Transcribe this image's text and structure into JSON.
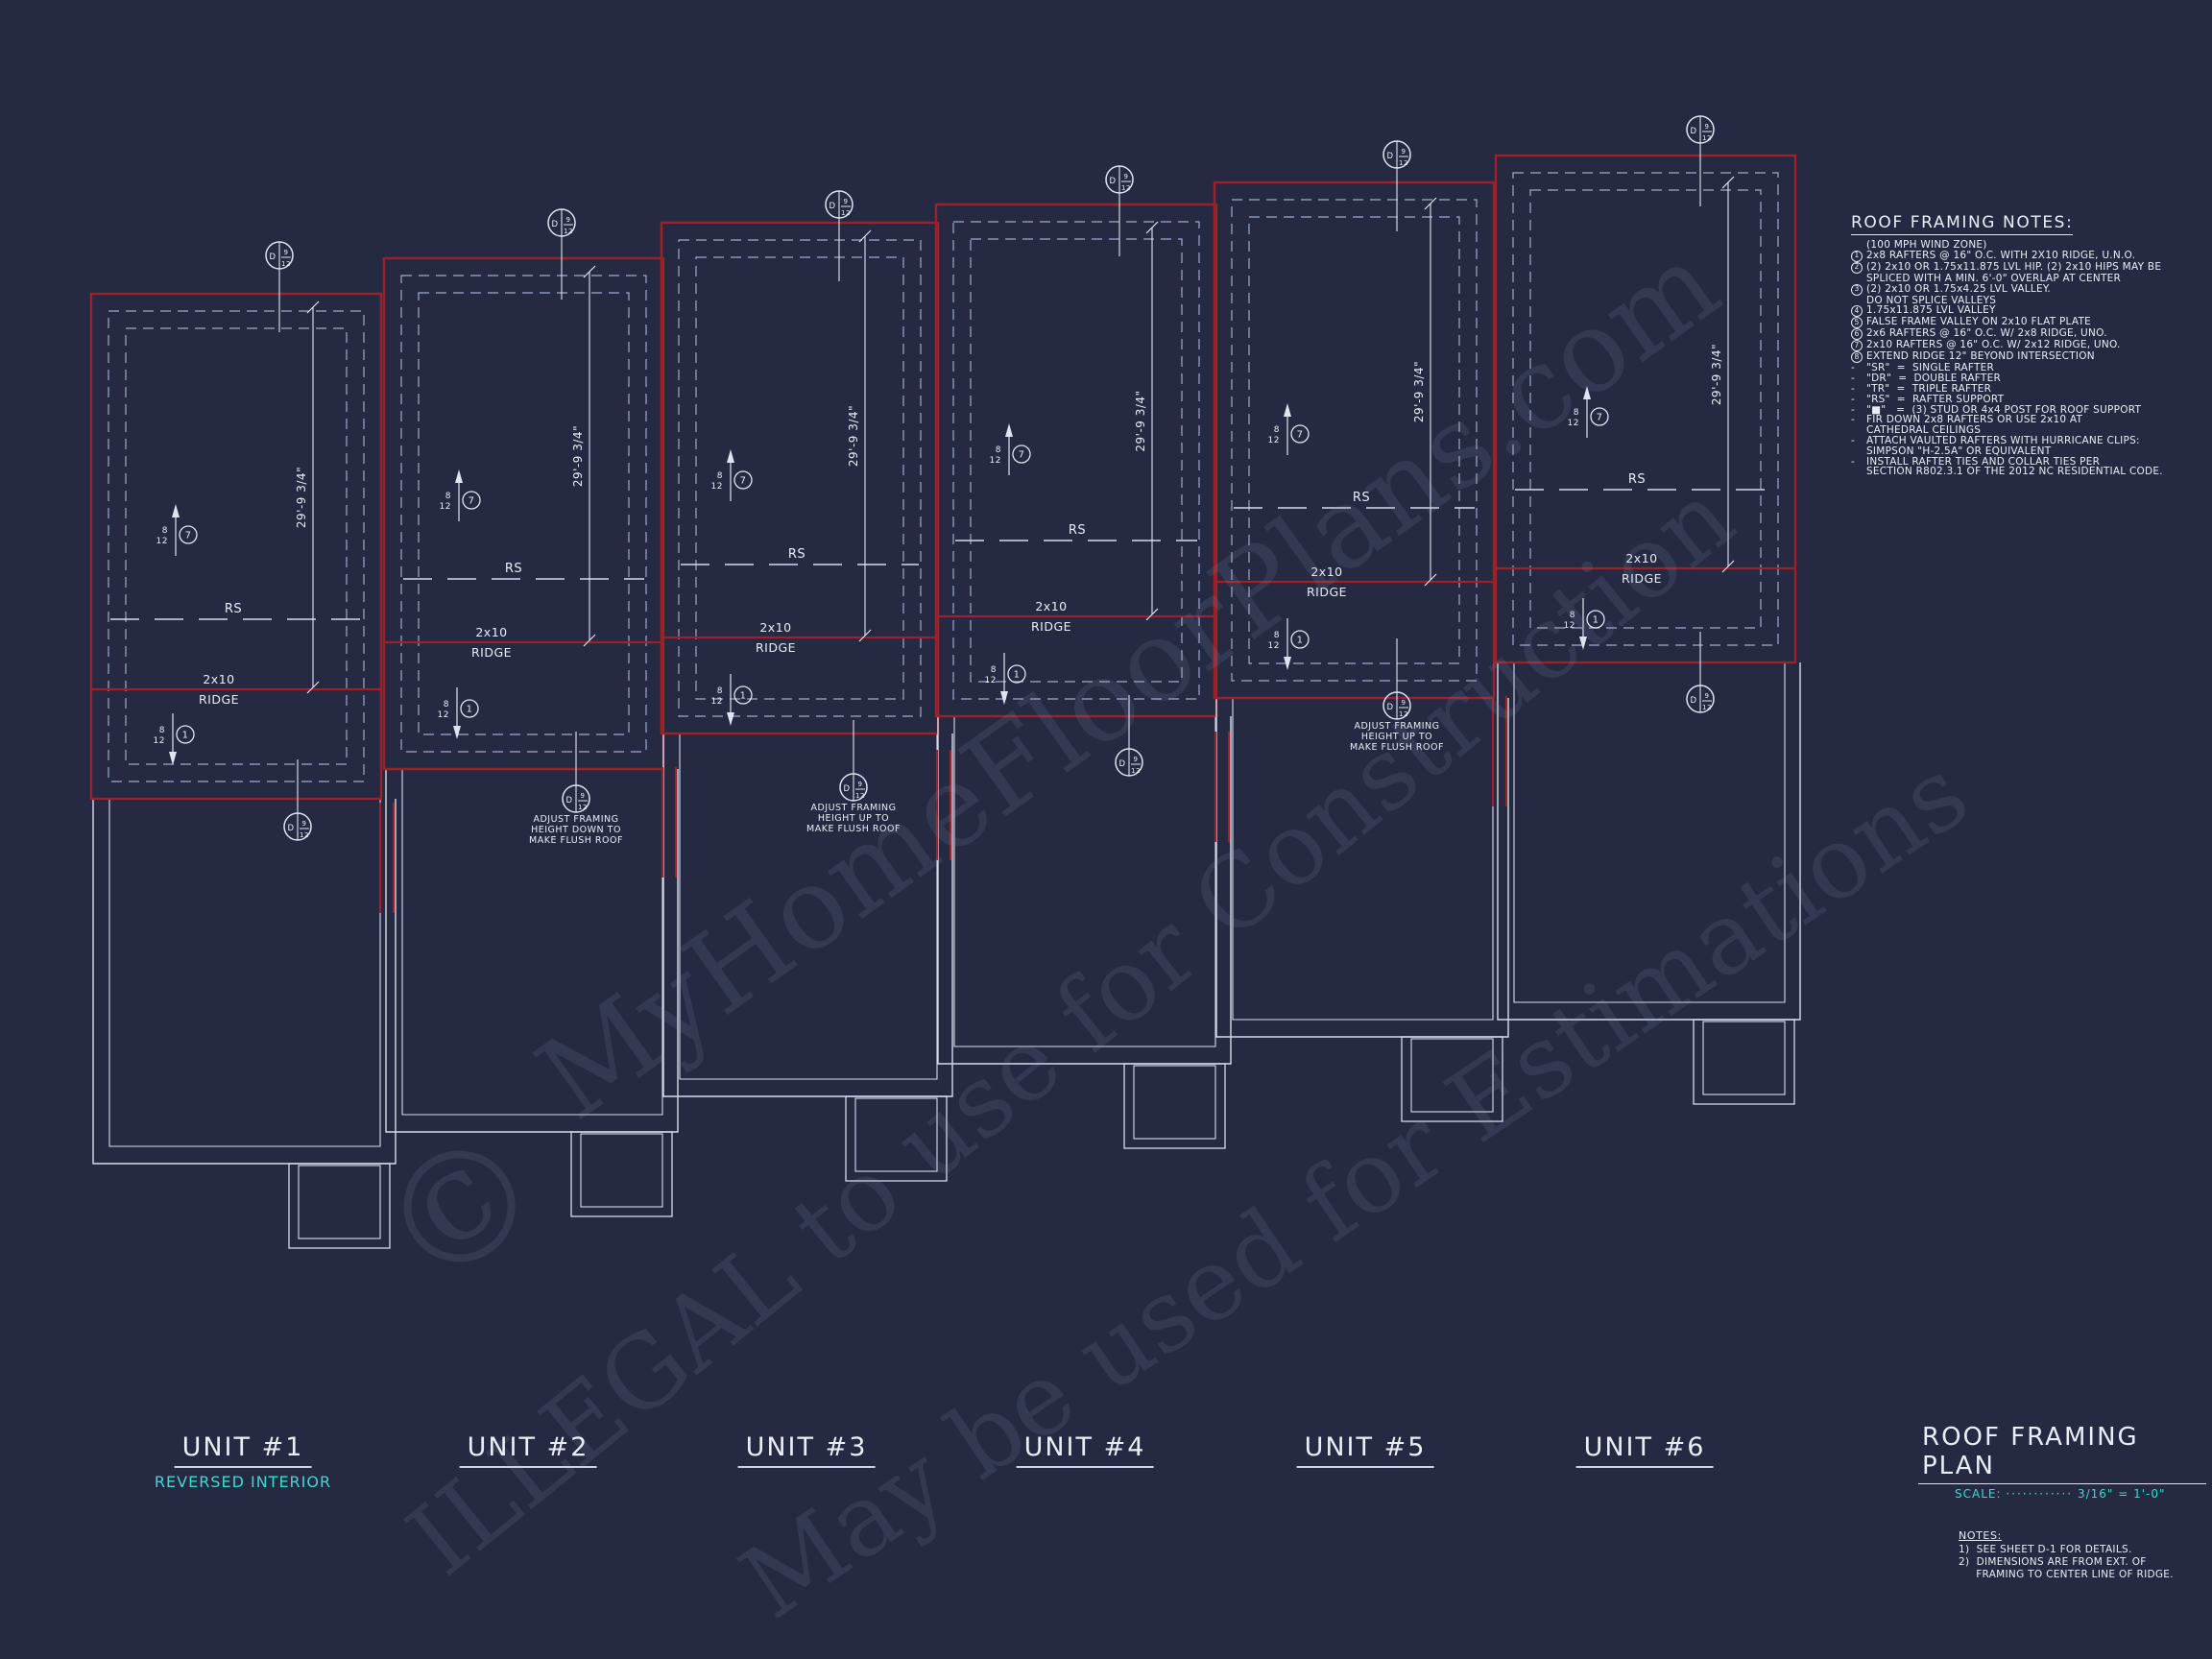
{
  "page": {
    "background": "#252a42"
  },
  "colors": {
    "line_red": "#9c2129",
    "line_white": "#dfe4f2",
    "line_gray": "#d6dbec",
    "dash_blue": "#9faacf",
    "text_white": "#e9edf8",
    "cyan": "#3fd9cf",
    "watermark": "rgba(155,165,200,0.13)"
  },
  "watermark": {
    "copyright": "©",
    "line1": "MyHomeFloorPlans.com",
    "line2": "ILLEGAL to use for Construction",
    "line3": "May be used for Estimations"
  },
  "drawing": {
    "ridge_label_top": "2x10",
    "ridge_label_bottom": "RIDGE",
    "rs_label": "RS",
    "dim_label": "29'-9 3/4\"",
    "pitch_top": "8",
    "pitch_bottom": "12",
    "callout_left": "D",
    "callout_right_top": "9",
    "callout_right_bottom": "12",
    "marker_up_note": "7",
    "marker_down_note": "1",
    "adjust_down": [
      "ADJUST FRAMING",
      "HEIGHT DOWN TO",
      "MAKE FLUSH ROOF"
    ],
    "adjust_up": [
      "ADJUST FRAMING",
      "HEIGHT UP TO",
      "MAKE FLUSH ROOF"
    ]
  },
  "units": [
    {
      "label": "UNIT #1",
      "sublabel": "REVERSED INTERIOR"
    },
    {
      "label": "UNIT #2",
      "sublabel": ""
    },
    {
      "label": "UNIT #3",
      "sublabel": ""
    },
    {
      "label": "UNIT #4",
      "sublabel": ""
    },
    {
      "label": "UNIT #5",
      "sublabel": ""
    },
    {
      "label": "UNIT #6",
      "sublabel": ""
    }
  ],
  "notes_panel": {
    "title": "ROOF FRAMING NOTES:",
    "rows": [
      {
        "m": "",
        "t": "(100 MPH WIND ZONE)"
      },
      {
        "m": "1",
        "t": "2x8 RAFTERS @ 16\" O.C. WITH 2X10 RIDGE, U.N.O."
      },
      {
        "m": "2",
        "t": "(2) 2x10 OR 1.75x11.875 LVL HIP. (2) 2x10 HIPS MAY BE"
      },
      {
        "m": "",
        "t": "SPLICED WITH A MIN. 6'-0\" OVERLAP AT CENTER"
      },
      {
        "m": "3",
        "t": "(2) 2x10 OR 1.75x4.25 LVL VALLEY."
      },
      {
        "m": "",
        "t": "DO NOT SPLICE VALLEYS"
      },
      {
        "m": "4",
        "t": "1.75x11.875 LVL VALLEY"
      },
      {
        "m": "5",
        "t": "FALSE FRAME VALLEY ON 2x10 FLAT PLATE"
      },
      {
        "m": "6",
        "t": "2x6 RAFTERS @ 16\" O.C. W/ 2x8 RIDGE, UNO."
      },
      {
        "m": "7",
        "t": "2x10 RAFTERS @ 16\" O.C. W/ 2x12 RIDGE, UNO."
      },
      {
        "m": "8",
        "t": "EXTEND RIDGE 12\" BEYOND INTERSECTION"
      },
      {
        "m": "-",
        "t": "\"SR\"  =  SINGLE RAFTER"
      },
      {
        "m": "-",
        "t": "\"DR\"  =  DOUBLE RAFTER"
      },
      {
        "m": "-",
        "t": "\"TR\"  =  TRIPLE RAFTER"
      },
      {
        "m": "-",
        "t": "\"RS\"  =  RAFTER SUPPORT"
      },
      {
        "m": "-",
        "t": "\"■\"   =  (3) STUD OR 4x4 POST FOR ROOF SUPPORT"
      },
      {
        "m": "-",
        "t": "FIR DOWN 2x8 RAFTERS OR USE 2x10 AT"
      },
      {
        "m": "",
        "t": "CATHEDRAL CEILINGS"
      },
      {
        "m": "-",
        "t": "ATTACH VAULTED RAFTERS WITH HURRICANE CLIPS:"
      },
      {
        "m": "",
        "t": "SIMPSON \"H-2.5A\" OR EQUIVALENT"
      },
      {
        "m": "-",
        "t": "INSTALL RAFTER TIES AND COLLAR TIES PER"
      },
      {
        "m": "",
        "t": "SECTION R802.3.1 OF THE 2012 NC RESIDENTIAL CODE."
      }
    ]
  },
  "title_block": {
    "title": "ROOF FRAMING PLAN",
    "scale_label": "SCALE:",
    "scale_dots": "············",
    "scale_value": "3/16\" = 1'-0\"",
    "notes_title": "NOTES:",
    "notes": [
      "1)  SEE SHEET D-1 FOR DETAILS.",
      "2)  DIMENSIONS ARE FROM EXT. OF",
      "     FRAMING TO CENTER LINE OF RIDGE."
    ]
  }
}
